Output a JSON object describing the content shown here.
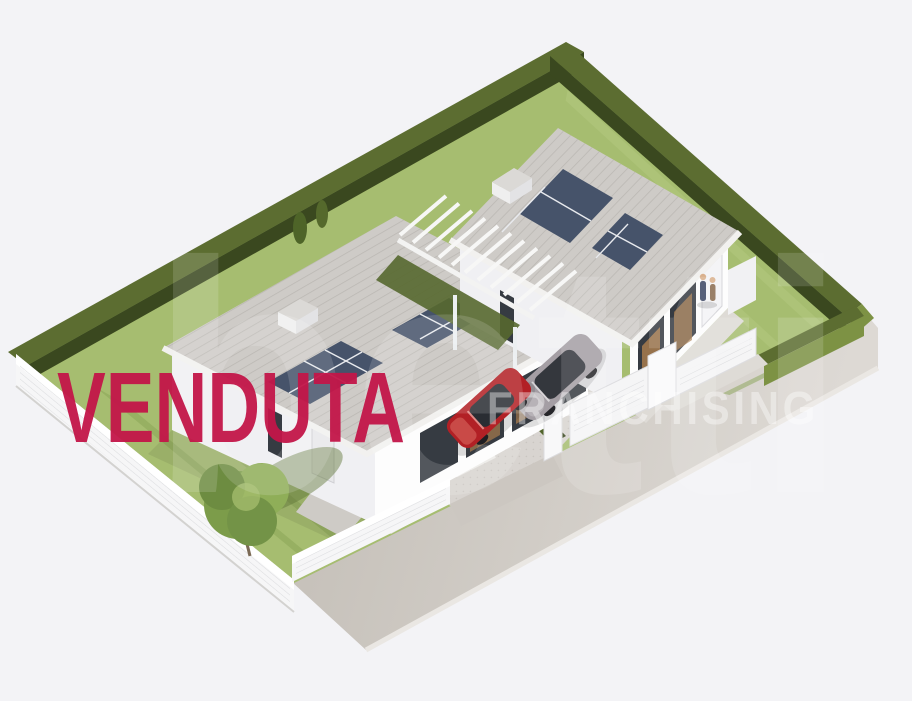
{
  "overlay": {
    "sold_label": "VENDUTA",
    "sold_color": "#c31649"
  },
  "watermark": {
    "brand_fragment": "betti",
    "franchise_label": "FRANCHISING",
    "color": "#ffffff"
  },
  "scene": {
    "colors": {
      "background": "#f3f3f6",
      "lawn": "#a6bd70",
      "lawn_stripe": "#87a254",
      "lawn_band": "#b8cc85",
      "hedge_top": "#5c6d31",
      "hedge_shadow": "#3a481f",
      "hedge_light": "#7d9244",
      "roof": "#cecbc7",
      "roof_rib": "#b5b2ad",
      "wall_light": "#fdfdfd",
      "wall_shade": "#f0f0f3",
      "glass": "#363b42",
      "wood": "#a87c4e",
      "solar": "#46536a",
      "street": "#c9c4be",
      "street_far": "#ddd9d4",
      "fence": "#f6f6f7",
      "path": "#dedbd6",
      "pad": "#d8d4d0",
      "car_red": "#b22025",
      "car_silver": "#a49ea4",
      "tree": "#7c9c4a"
    }
  }
}
